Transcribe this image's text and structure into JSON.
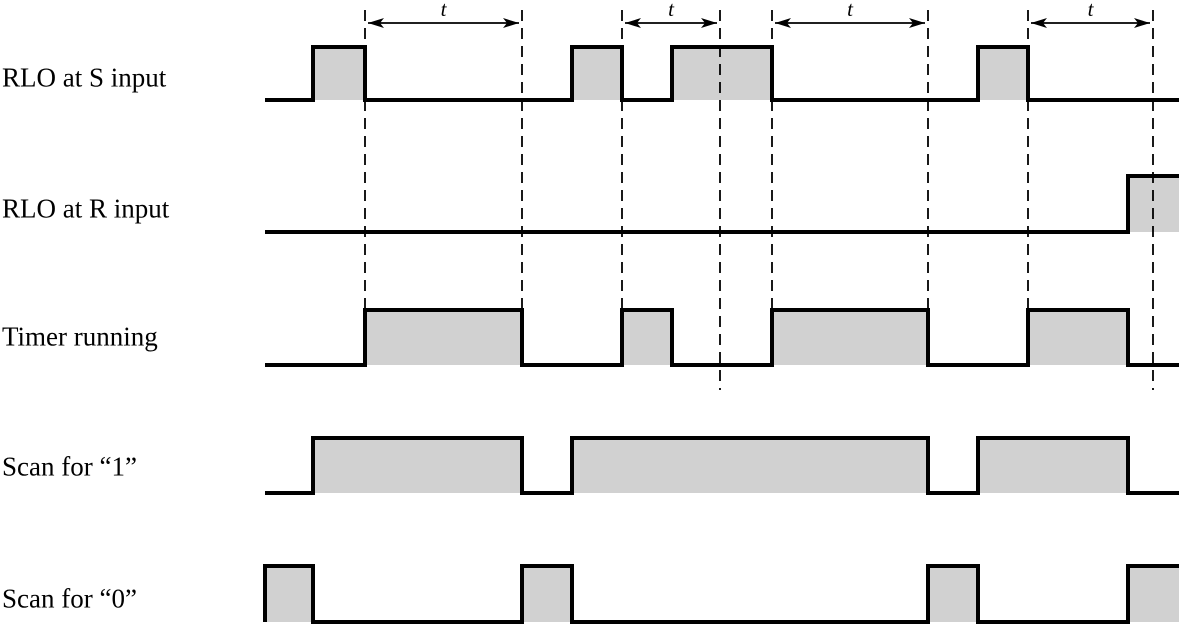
{
  "diagram": {
    "type": "timing-diagram",
    "background_color": "#ffffff",
    "line_color": "#000000",
    "pulse_fill_color": "#d1d1d1",
    "canvas": {
      "width": 1179,
      "height": 625
    },
    "x_start": 265,
    "x_end": 1179,
    "rows": [
      {
        "id": "rlo-s-input",
        "label": "RLO at S input",
        "label_center_y": 78,
        "base_y": 100,
        "top_y": 47,
        "pulses": [
          [
            313,
            365
          ],
          [
            572,
            622
          ],
          [
            672,
            772
          ],
          [
            978,
            1028
          ]
        ]
      },
      {
        "id": "rlo-r-input",
        "label": "RLO at R input",
        "label_center_y": 209,
        "base_y": 232,
        "top_y": 176,
        "pulses": [
          [
            1128,
            1179
          ]
        ]
      },
      {
        "id": "timer-running",
        "label": "Timer running",
        "label_center_y": 337,
        "base_y": 365,
        "top_y": 310,
        "pulses": [
          [
            365,
            522
          ],
          [
            622,
            672
          ],
          [
            772,
            928
          ],
          [
            1028,
            1128
          ]
        ]
      },
      {
        "id": "scan-for-1",
        "label": "Scan for “1”",
        "label_center_y": 467,
        "base_y": 493,
        "top_y": 438,
        "pulses": [
          [
            313,
            522
          ],
          [
            572,
            928
          ],
          [
            978,
            1128
          ]
        ]
      },
      {
        "id": "scan-for-0",
        "label": "Scan for “0”",
        "label_center_y": 599,
        "base_y": 622,
        "top_y": 566,
        "pulses": [
          [
            265,
            313
          ],
          [
            522,
            572
          ],
          [
            928,
            978
          ],
          [
            1128,
            1179
          ]
        ]
      }
    ],
    "dashed_lines": [
      {
        "x": 365,
        "y1": 10,
        "y2": 312
      },
      {
        "x": 522,
        "y1": 10,
        "y2": 312
      },
      {
        "x": 622,
        "y1": 10,
        "y2": 312
      },
      {
        "x": 720,
        "y1": 10,
        "y2": 390
      },
      {
        "x": 772,
        "y1": 10,
        "y2": 312
      },
      {
        "x": 928,
        "y1": 10,
        "y2": 312
      },
      {
        "x": 1028,
        "y1": 10,
        "y2": 312
      },
      {
        "x": 1153,
        "y1": 10,
        "y2": 390
      }
    ],
    "time_markers": [
      {
        "label": "t",
        "x1": 365,
        "x2": 522,
        "arrow_y": 23,
        "label_y": 16
      },
      {
        "label": "t",
        "x1": 622,
        "x2": 720,
        "arrow_y": 23,
        "label_y": 16
      },
      {
        "label": "t",
        "x1": 772,
        "x2": 928,
        "arrow_y": 23,
        "label_y": 16
      },
      {
        "label": "t",
        "x1": 1028,
        "x2": 1153,
        "arrow_y": 23,
        "label_y": 16
      }
    ],
    "style": {
      "waveform_stroke_width": 4,
      "dashed_stroke_width": 1.8,
      "dash_pattern": "11,7",
      "arrow_stroke_width": 1.8,
      "time_label_font_size": 21,
      "row_label_font_size": 27
    }
  }
}
